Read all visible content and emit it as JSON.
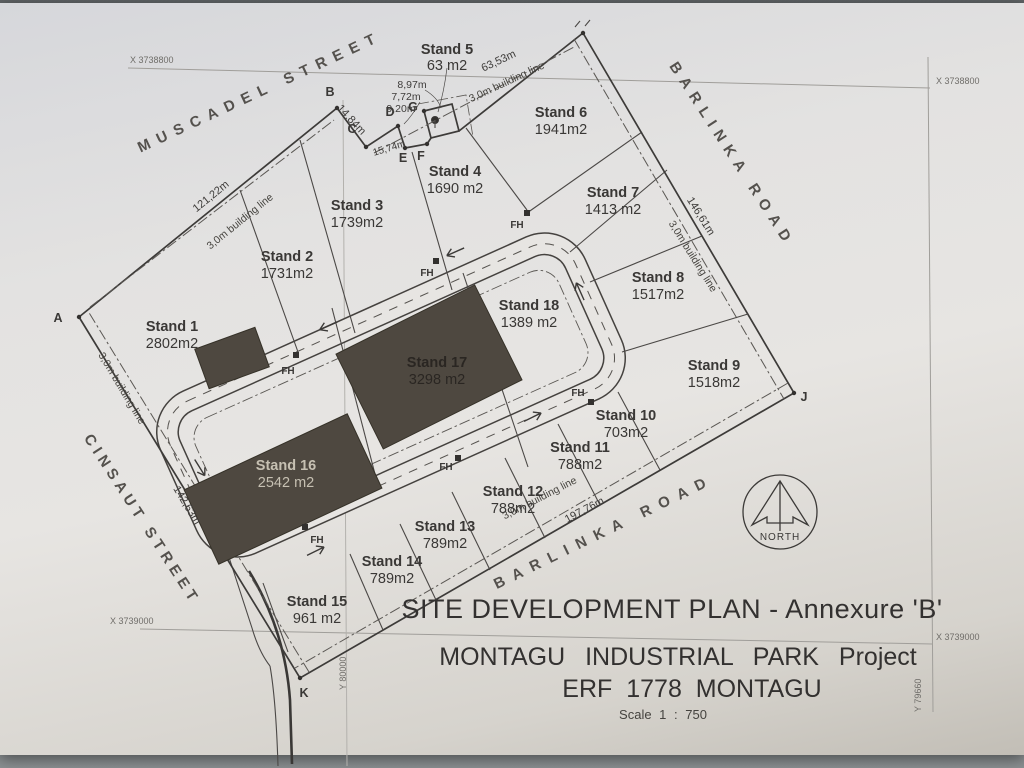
{
  "photo": {
    "paper_color": "#e5e4e2",
    "background_color": "#8b9092",
    "ink_color": "#3a3836",
    "building_fill": "#4e4840"
  },
  "title_block": {
    "line1": "SITE DEVELOPMENT PLAN  -  Annexure 'B'",
    "line2": "MONTAGU INDUSTRIAL PARK Project",
    "line3": "ERF 1778 MONTAGU",
    "scale": "Scale 1 : 750"
  },
  "north_arrow": {
    "label": "NORTH"
  },
  "streets": {
    "muscadel": "MUSCADEL STREET",
    "barlinka_top": "BARLINKA ROAD",
    "barlinka_bottom": "BARLINKA ROAD",
    "cinsaut": "CINSAUT STREET"
  },
  "grid_labels": {
    "x_top": "X 3738800",
    "x_bottom": "X 3739000",
    "y_mid": "Y 80000",
    "y_right": "Y 79660"
  },
  "stands": [
    {
      "name": "Stand 1",
      "area": "2802m2"
    },
    {
      "name": "Stand 2",
      "area": "1731m2"
    },
    {
      "name": "Stand 3",
      "area": "1739m2"
    },
    {
      "name": "Stand 4",
      "area": "1690 m2"
    },
    {
      "name": "Stand 5",
      "area": "63 m2"
    },
    {
      "name": "Stand 6",
      "area": "1941m2"
    },
    {
      "name": "Stand 7",
      "area": "1413 m2"
    },
    {
      "name": "Stand 8",
      "area": "1517m2"
    },
    {
      "name": "Stand 9",
      "area": "1518m2"
    },
    {
      "name": "Stand 10",
      "area": "703m2"
    },
    {
      "name": "Stand 11",
      "area": "788m2"
    },
    {
      "name": "Stand 12",
      "area": "788m2"
    },
    {
      "name": "Stand 13",
      "area": "789m2"
    },
    {
      "name": "Stand 14",
      "area": "789m2"
    },
    {
      "name": "Stand 15",
      "area": "961 m2"
    },
    {
      "name": "Stand 16",
      "area": "2542 m2"
    },
    {
      "name": "Stand 17",
      "area": "3298 m2"
    },
    {
      "name": "Stand 18",
      "area": "1389 m2"
    }
  ],
  "dimensions": {
    "muscadel_frontage": "121,22m",
    "b_c": "14,84m",
    "c_e": "15,74m",
    "notch_1": "8,97m",
    "notch_2": "7,72m",
    "notch_3": "9,20m",
    "top_right": "63,53m",
    "barlinka_east": "146,61m",
    "barlinka_south": "197,76m",
    "cinsaut_west": "142,63m"
  },
  "building_line_label": "3,0m building line",
  "fire_hydrant_label": "FH",
  "vertex_labels": {
    "a": "A",
    "b": "B",
    "c": "C",
    "d": "D",
    "e": "E",
    "f": "F",
    "g": "G",
    "j": "J",
    "k": "K"
  }
}
